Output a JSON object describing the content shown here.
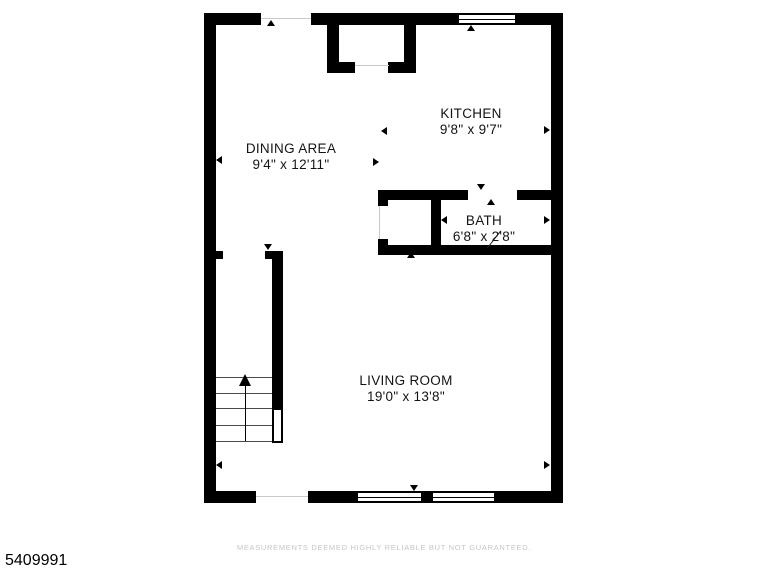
{
  "rooms": [
    {
      "name": "KITCHEN",
      "dimensions": "9'8\" x 9'7\""
    },
    {
      "name": "DINING AREA",
      "dimensions": "9'4\" x 12'11\""
    },
    {
      "name": "BATH",
      "dimensions": "6'8\" x 2'8\""
    },
    {
      "name": "LIVING ROOM",
      "dimensions": "19'0\" x 13'8\""
    }
  ],
  "footer": {
    "disclaimer": "MEASUREMENTS DEEMED HIGHLY RELIABLE BUT NOT GUARANTEED.",
    "listing_number": "5409991"
  },
  "colors": {
    "wall": "#000000",
    "background": "#ffffff",
    "disclaimer_text": "#c6c6c6"
  }
}
